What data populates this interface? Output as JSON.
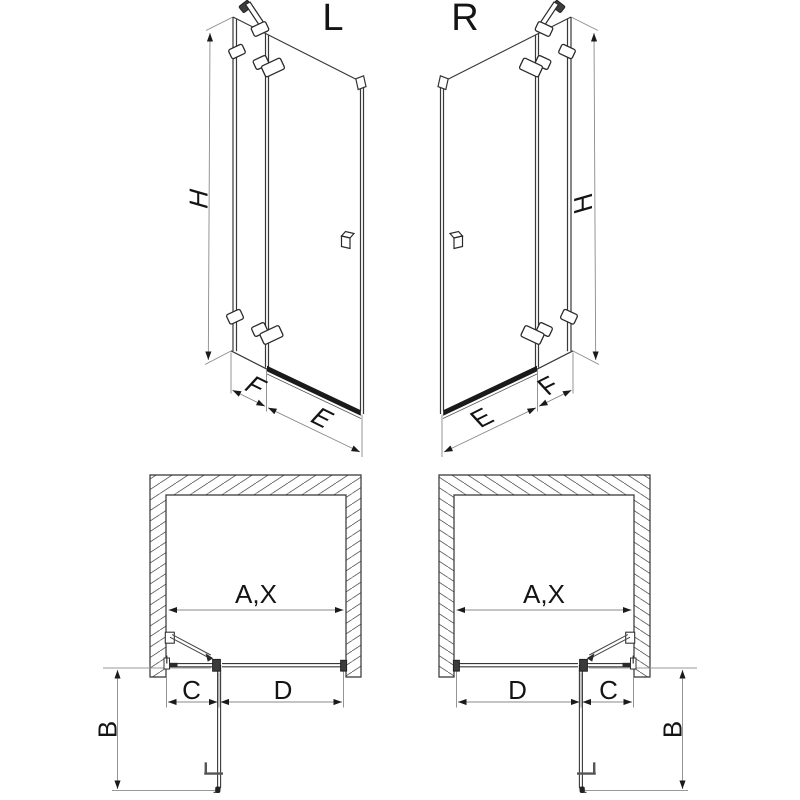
{
  "palette": {
    "line": "#333333",
    "dim_line": "#8a8a8a",
    "arrow": "#1a1a1a",
    "dark_fill": "#1a1a1a",
    "background": "#ffffff"
  },
  "diagrams": {
    "iso_left": {
      "label": "L",
      "height_dim": "H",
      "fixed_panel_dim": "F",
      "door_dim": "E"
    },
    "iso_right": {
      "label": "R",
      "height_dim": "H",
      "fixed_panel_dim": "F",
      "door_dim": "E"
    },
    "plan_left": {
      "opening_dim": "A,X",
      "c_dim": "C",
      "d_dim": "D",
      "b_dim": "B"
    },
    "plan_right": {
      "opening_dim": "A,X",
      "c_dim": "C",
      "d_dim": "D",
      "b_dim": "B"
    }
  }
}
